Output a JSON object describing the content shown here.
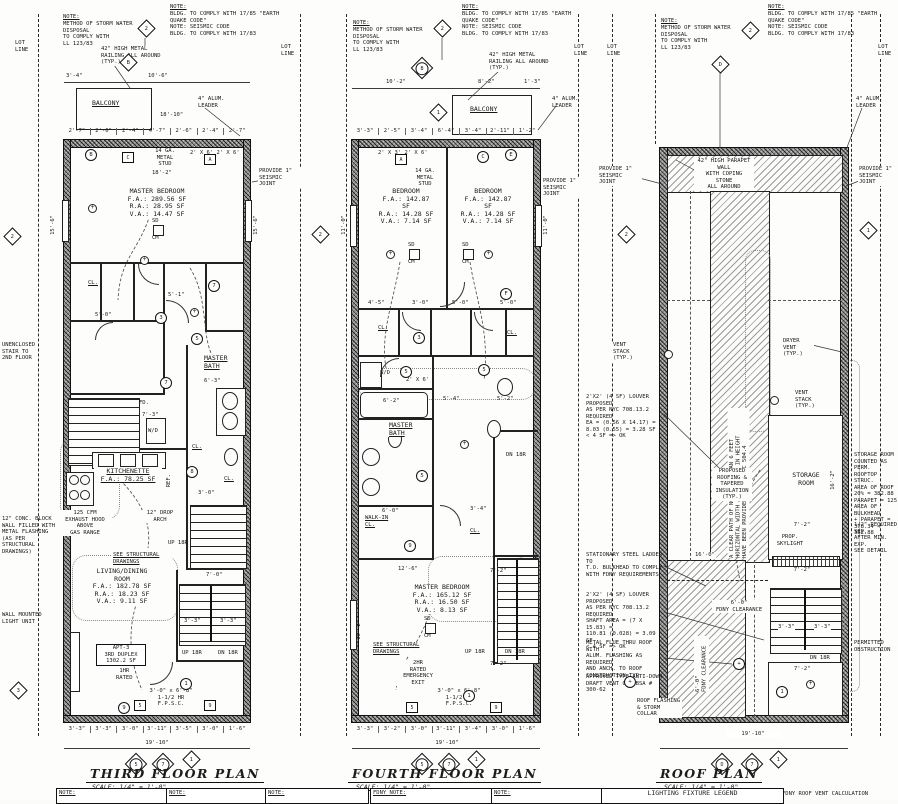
{
  "sheet": {
    "bg": "#fdfdfc",
    "ink": "#1c1c1c"
  },
  "shared": {
    "note_title": "NOTE:",
    "storm": "METHOD OF STORM WATER DISPOSAL\nTO COMPLY WITH\nLL 123/83",
    "code": "BLDG. TO COMPLY WITH 17/85 \"EARTH\nQUAKE CODE\"\nNOTE: SEISMIC CODE\nBLDG. TO COMPLY WITH 17/83",
    "lot": "LOT\nLINE",
    "railing": "42\" HIGH METAL\nRAILING ALL AROUND\n(TYP.)",
    "leader": "4\" ALUM.\nLEADER",
    "seismic": "PROVIDE 1\"\nSEISMIC JOINT",
    "stud": "14 GA.\nMETAL\nSTUD",
    "balcony": "BALCONY",
    "see_struct": "SEE STRUCTURAL\nDRAWINGS",
    "fpsc": "3'-0\" x 6'-8\"\n1-1/2 HR\nF.P.S.C.",
    "up": "UP 18R",
    "dn": "DN 18R",
    "wd": "W/D",
    "cl": "CL.",
    "fd": "FD.",
    "ref": "REF.",
    "sd": "SD",
    "cm": "CM"
  },
  "third": {
    "title": "THIRD FLOOR PLAN",
    "scale": "SCALE: 1/4\" = 1'-0\"",
    "stud_dim": "18'-2\"",
    "joist": "2' X 6'   2' X 6'",
    "master_bedroom": "MASTER BEDROOM\nF.A.: 289.56 SF\nR.A.: 28.95 SF\nV.A.: 14.47 SF",
    "master_bath": "MASTER\nBATH",
    "kitchenette": "KITCHENETTE\nF.A.: 78.25 SF",
    "hood": "125 CFM\nEXHAUST HOOD\nABOVE\nGAS RANGE",
    "drop_arch": "12\" DROP\nARCH",
    "living": "LIVING/DINING\nROOM\nF.A.: 182.78 SF\nR.A.: 18.23 SF\nV.A.: 9.11 SF",
    "apt": "APT-3\n3RD DUPLEX\n1302.2 SF",
    "rated": "1HR\nRATED",
    "unenclosed": "UNENCLOSED\nSTAIR TO\n2ND FLOOR",
    "conc": "12\" CONC. BLOCK\nWALL FILLED WITH\nMETAL FLASHING\n(AS PER\nSTRUCTURAL\nDRAWINGS)",
    "wall_light": "WALL MOUNTED\nLIGHT UNIT",
    "d_top1": "3'-4\"",
    "d_top2": "10'-6\"",
    "d_mid": "18'-10\"",
    "d_row": [
      "2'-7\"",
      "2'-6\"",
      "2'-4\"",
      "4'-7\"",
      "2'-6\"",
      "2'-4\"",
      "2'-7\""
    ],
    "d_left": "15'-6\"",
    "d_right": "15'-6\"",
    "d5_0": "5'-0\"",
    "d5_1": "5'-1\"",
    "d6_3": "6'-3\"",
    "d3_1": "3'-1\"",
    "d7_3": "7'-3\"",
    "d3_0": "3'-0\"",
    "d7_0": "7'-0\"",
    "d3_3a": "3'-3\"",
    "d3_3b": "3'-3\"",
    "d_bot": [
      "3'-3\"",
      "3'-3\"",
      "3'-0\"",
      "3'-11\"",
      "3'-5\"",
      "3'-0\"",
      "1'-6\""
    ],
    "d_total": "19'-10\"",
    "sym": {
      "storm": "2",
      "top": "B",
      "cb": "B",
      "hc": "C",
      "ha": "A",
      "c3": "3",
      "c7a": "7",
      "c5": "5",
      "c7b": "7",
      "c8": "8",
      "c9": "9",
      "c1": "1",
      "h5": "5",
      "h9": "9",
      "side": "2",
      "left": "3",
      "ta": "5",
      "tb": "7",
      "tc": "1"
    }
  },
  "fourth": {
    "title": "FOURTH FLOOR PLAN",
    "scale": "SCALE: 1/4\" = 1'-0\"",
    "joist": "2' X 3'   2' X 6'",
    "bedroom_l": "BEDROOM\nF.A.: 142.87 SF\nR.A.: 14.28 SF\nV.A.: 7.14 SF",
    "bedroom_r": "BEDROOM\nF.A.: 142.87 SF\nR.A.: 14.28 SF\nV.A.: 7.14 SF",
    "master_bath": "MASTER\nBATH",
    "walkin": "WALK-IN\nCL.",
    "master_bedroom": "MASTER BEDROOM\nF.A.: 165.12 SF\nR.A.: 16.50 SF\nV.A.: 8.13 SF",
    "emergency": "2HR\nRATED\nEMERGENCY\nEXIT",
    "d_top": [
      "10'-2\"",
      "8'-2\"",
      "1'-3\""
    ],
    "d_row": [
      "3'-3\"",
      "2'-5\"",
      "3'-4\"",
      "6'-4\"",
      "3'-4\"",
      "2'-11\"",
      "1'-2\""
    ],
    "d_left": "11'-0\"",
    "d_right": "11'-0\"",
    "d_left2": "16'-2\"",
    "d4_5": "4'-5\"",
    "d3_0": "3'-0\"",
    "d5_0a": "5'-0\"",
    "d5_0b": "5'-0\"",
    "d6_2": "6'-2\"",
    "d5_4": "5'-4\"",
    "d5_2": "5'-2\"",
    "d2x6": "2' X 6'",
    "d6_0": "6'-0\"",
    "d3_4": "3'-4\"",
    "d12_6": "12'-6\"",
    "d7_2a": "7'-2\"",
    "d7_2b": "7'-2\"",
    "d3_3a": "3'-3\"",
    "d3_3b": "3'-3\"",
    "d_bot": [
      "3'-3\"",
      "3'-2\"",
      "3'-0\"",
      "3'-11\"",
      "3'-4\"",
      "3'-0\"",
      "1'-6\""
    ],
    "d_total": "19'-10\"",
    "sym": {
      "storm": "2",
      "top": "B",
      "d1": "1",
      "ha": "A",
      "cc": "C",
      "ce": "E",
      "cf": "F",
      "c3": "3",
      "c5a": "5",
      "c5b": "5",
      "c5c": "5",
      "c9": "9",
      "c1": "1",
      "h5": "5",
      "h9": "9",
      "side": "2",
      "ta": "5",
      "tb": "7",
      "tc": "1"
    }
  },
  "roof": {
    "title": "ROOF PLAN",
    "scale": "SCALE: 1/4\" = 1'-0\"",
    "parapet": "42\" HIGH PARAPET\nWALL\nWITH COPING\nSTONE\nALL AROUND",
    "vent": "VENT\nSTACK\n(TYP.)",
    "dryer": "DRYER\nVENT\n(TYP.)",
    "ladder": "STATIONARY STEEL LADDER TO\nT.O. BULKHEAD TO COMPLY\nWITH FDNY REQUIREMENTS",
    "louver1": "2'X2' (4 SF) LOUVER PROPOSED\nAS PER NYC 708.13.2 REQUIRED\nEA = (0.56 X 14.17) =\n8.03 (0.55) = 3.28 SF\n< 4 SF => OK",
    "louver2": "2'X2' (4 SF) LOUVER PROPOSED\nAS PER NYC 708.13.2 REQUIRED\nSHAFT AREA = (7 X 15.83) =\n110.81 (0.028) = 3.09 SF\n< 4 SF => OK",
    "flue": "METAL FLUE THRU ROOF WITH\nALUM. FLASHING AS REQUIRED\nAND ANCH. TO ROOF\nCONSTRUCTION-TYP.",
    "antidraft": "APPROVED TYPE ANTI-DOWN\nDRAFT VENT CAP BSA # 300-62",
    "flashing": "ROOF FLASHING\n& STORM COLLAR",
    "clearpath": "A CLEAR PATH OF NOT LESS THAN 6 FEET\nHORIZONTAL WIDTH AND 9 FEET IN HEIGHT\nHAVE BEEN PROVIDED AS PER FC 504.4",
    "clearance": "6'-0\"\nFDNY CLEARANCE",
    "storage": "STORAGE\nROOM",
    "skylight": "PROP.\nSKYLIGHT",
    "roofing": "PROPOSED\nROOFING &\nTAPERED\nINSULATION\n(TYP.)",
    "storage_note": "STORAGE ROOM\nCOUNTED AS PERM.\nROOFTOP STRUC.\nAREA OF ROOF\n20% = 382.88\nPARAPET = 125\nAREA OF BULKHEAD\n+ PARAPET =\n378.34 < 382.88",
    "detail_note": "1/2\" REQUIRED SEP.\nAFTER MIN. EXP.\nSEE DETAIL",
    "obstruction": "PERMITTED\nOBSTRUCTION",
    "d16_0": "16'-0\"",
    "d16_2": "16'-2\"",
    "d7_2a": "7'-2\"",
    "d7_2b": "7'-2\"",
    "d7_2c": "7'-2\"",
    "d3_3a": "3'-3\"",
    "d3_3b": "3'-3\"",
    "d_total": "19'-10\"",
    "sym": {
      "storm": "2",
      "top": "D",
      "right": "1",
      "c1": "1",
      "ta": "D",
      "tb": "7",
      "tc": "1"
    }
  },
  "footer": {
    "b0": "NOTE:",
    "b1": "NOTE:",
    "b2": "NOTE:",
    "b3": "FDNY NOTE:",
    "b4": "NOTE:",
    "legend": "LIGHTING FIXTURE LEGEND",
    "fdny": "FDNY ROOF VENT CALCULATION"
  }
}
